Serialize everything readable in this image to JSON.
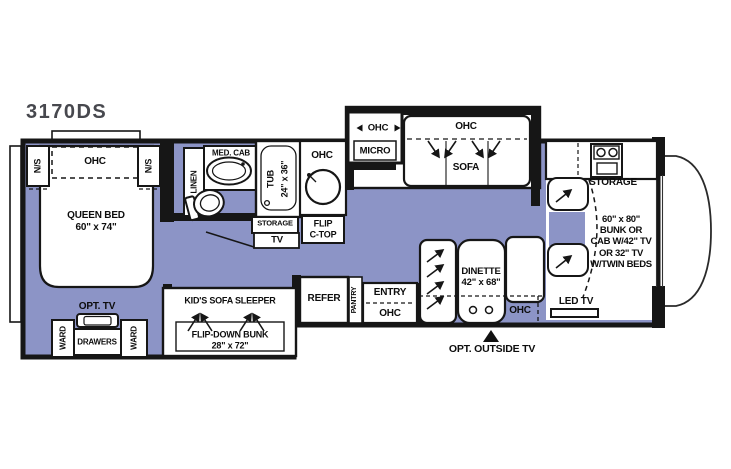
{
  "title": {
    "model": "3170DS"
  },
  "colors": {
    "floor": "#8c94c6",
    "wall": "#161616",
    "model_text": "#47484e"
  },
  "bedroom": {
    "ns_left": "N/S",
    "ohc": "OHC",
    "ns_right": "N/S",
    "queen_bed": "QUEEN BED\n60\" x 74\"",
    "opt_tv": "OPT. TV",
    "ward_left": "WARD",
    "drawers": "DRAWERS",
    "ward_right": "WARD"
  },
  "bathroom": {
    "linen": "LINEN",
    "med_cab": "MED. CAB",
    "tub": "TUB",
    "tub_size": "24\" x 36\"",
    "storage": "STORAGE",
    "tv": "TV"
  },
  "galley": {
    "ohc": "OHC",
    "flip_ctop": "FLIP\nC-TOP"
  },
  "entertainment_center": {
    "ohc": "OHC",
    "micro": "MICRO"
  },
  "sofa_slide": {
    "ohc": "OHC",
    "sofa": "SOFA"
  },
  "kids_area": {
    "sofa_sleeper": "KID'S SOFA SLEEPER",
    "flip_down_bunk": "FLIP-DOWN BUNK\n28\" x 72\""
  },
  "entry_area": {
    "refer": "REFER",
    "pantry": "PANTRY",
    "entry": "ENTRY",
    "ohc": "OHC"
  },
  "dinette": {
    "label": "DINETTE\n42\" x 68\"",
    "ohc": "OHC"
  },
  "exterior": {
    "opt_outside_tv": "OPT. OUTSIDE TV"
  },
  "cab": {
    "storage": "STORAGE",
    "bunk_option": "60\" x 80\"\nBUNK OR\nCAB W/42\" TV\nOR 32\" TV\nW/TWIN BEDS",
    "led_tv": "LED TV"
  }
}
